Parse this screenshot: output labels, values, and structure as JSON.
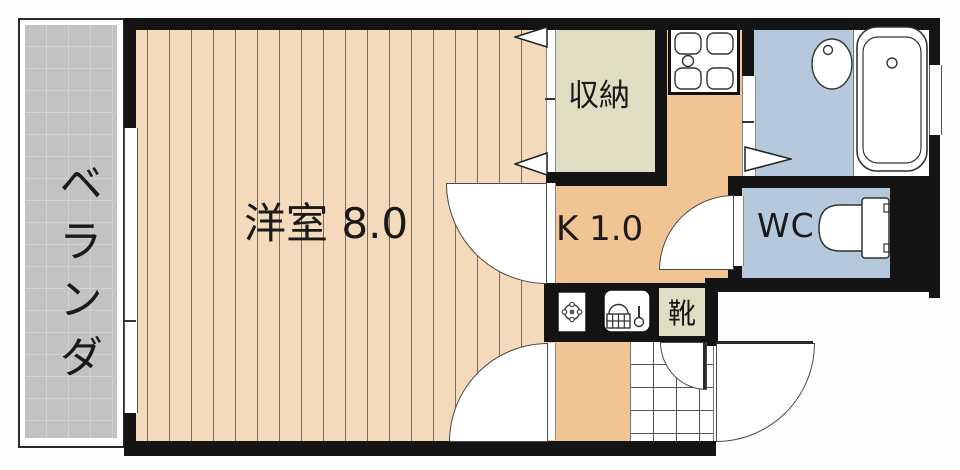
{
  "labels": {
    "veranda": "ベランダ",
    "main_room": "洋室 8.0",
    "closet": "収納",
    "kitchen": "K 1.0",
    "wc": "WC",
    "shoe_cabinet": "靴"
  },
  "rooms": [
    {
      "id": "veranda",
      "label": "ベランダ",
      "type": "balcony"
    },
    {
      "id": "main-room",
      "label": "洋室 8.0",
      "type": "western-style-room"
    },
    {
      "id": "closet",
      "label": "収納",
      "type": "storage"
    },
    {
      "id": "kitchen",
      "label": "K 1.0",
      "type": "kitchen"
    },
    {
      "id": "washroom",
      "label": "",
      "type": "washroom"
    },
    {
      "id": "bathroom",
      "label": "",
      "type": "bathroom"
    },
    {
      "id": "wc",
      "label": "WC",
      "type": "toilet"
    },
    {
      "id": "shoe-cabinet",
      "label": "靴",
      "type": "shoe-storage"
    },
    {
      "id": "genkan",
      "label": "",
      "type": "entrance"
    }
  ],
  "icons": [
    "stove-icon",
    "washer-pan-icon",
    "kitchen-sink-icon",
    "washbasin-icon",
    "bathtub-icon",
    "toilet-icon",
    "closet-door-triangle-icon",
    "folding-door-triangle-icon",
    "door-swing-arc",
    "entrance-door-swing-arc"
  ],
  "colors": {
    "wall": "#141414",
    "main_room_floor": "#f4d9ba",
    "room_stripe": "#786c5d",
    "kitchen_floor": "#f1c494",
    "closet_floor": "#dfdec3",
    "wet_area_floor": "#b5c8dc",
    "veranda_floor": "#c2c2c2",
    "background": "#ffffff"
  }
}
